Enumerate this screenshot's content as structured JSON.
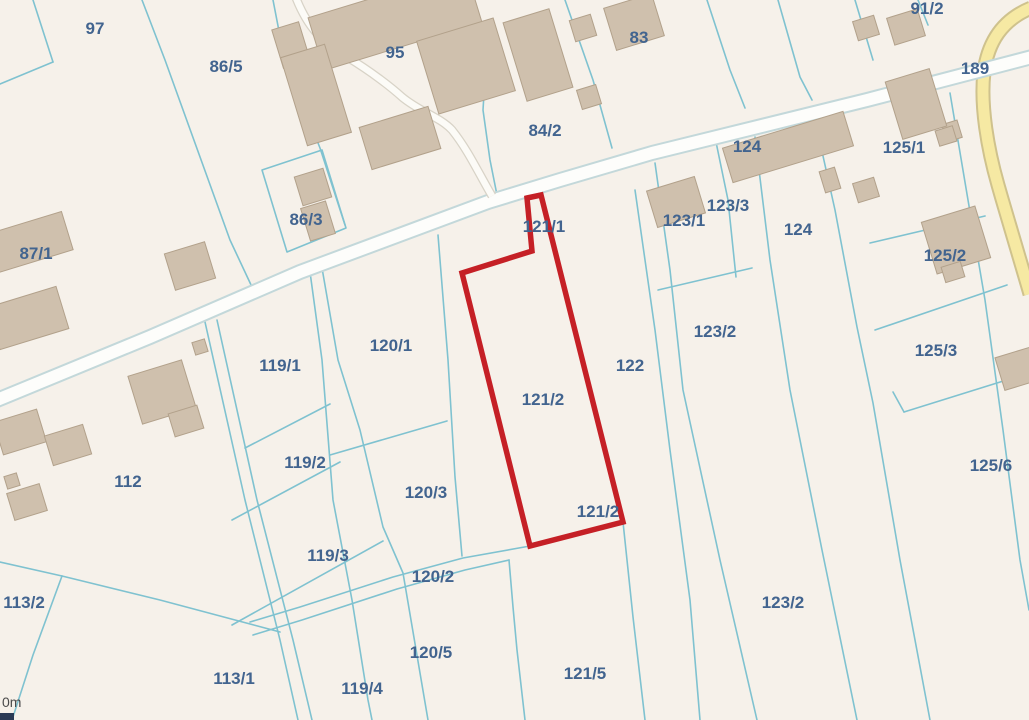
{
  "map": {
    "type": "cadastral-parcel-map",
    "background_color": "#f6f1ea",
    "boundary_color": "#7fc2d0",
    "label_color": "#42648f",
    "building_fill": "#cfc0ad",
    "building_stroke": "#b2a18b",
    "road_fill": "#fdfdfb",
    "road_casing": "#c3d8da",
    "yellow_road_fill": "#f6e9a3",
    "yellow_road_casing": "#cfc28d",
    "selected_parcel_color": "#c52026",
    "selected_parcel_number": "121/2",
    "scale_text": "0m",
    "labels": [
      {
        "text": "97"
      },
      {
        "text": "86/5"
      },
      {
        "text": "95"
      },
      {
        "text": "83"
      },
      {
        "text": "91/2"
      },
      {
        "text": "189"
      },
      {
        "text": "84/2"
      },
      {
        "text": "124"
      },
      {
        "text": "125/1"
      },
      {
        "text": "86/3"
      },
      {
        "text": "123/3"
      },
      {
        "text": "123/1"
      },
      {
        "text": "124"
      },
      {
        "text": "125/2"
      },
      {
        "text": "87/1"
      },
      {
        "text": "121/1"
      },
      {
        "text": "123/2"
      },
      {
        "text": "125/3"
      },
      {
        "text": "120/1"
      },
      {
        "text": "119/1"
      },
      {
        "text": "122"
      },
      {
        "text": "121/2"
      },
      {
        "text": "112"
      },
      {
        "text": "119/2"
      },
      {
        "text": "120/3"
      },
      {
        "text": "121/2"
      },
      {
        "text": "125/6"
      },
      {
        "text": "119/3"
      },
      {
        "text": "120/2"
      },
      {
        "text": "113/2"
      },
      {
        "text": "123/2"
      },
      {
        "text": "113/1"
      },
      {
        "text": "119/4"
      },
      {
        "text": "120/5"
      },
      {
        "text": "121/5"
      }
    ]
  }
}
